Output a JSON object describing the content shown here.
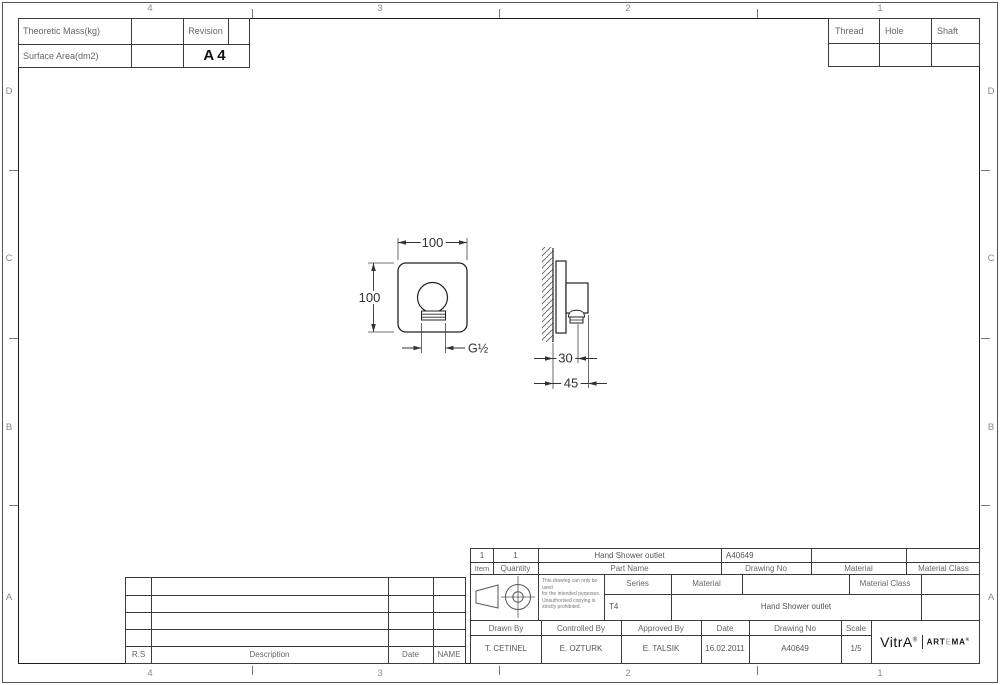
{
  "sheet": {
    "paper_size": "A4",
    "bg_color": "#ffffff",
    "line_color": "#3a3a3a",
    "frame_color": "#1a1a1a"
  },
  "zones": {
    "row_letters": [
      "D",
      "C",
      "B",
      "A"
    ],
    "col_numbers": [
      "4",
      "3",
      "2",
      "1"
    ]
  },
  "top_left_table": {
    "theoretic_mass_label": "Theoretic Mass(kg)",
    "theoretic_mass_value": "",
    "revision_label": "Revision",
    "revision_value": "",
    "surface_area_label": "Surface Area(dm2)",
    "surface_area_value": "",
    "paper_size": "A4"
  },
  "top_right_table": {
    "thread_label": "Thread",
    "hole_label": "Hole",
    "shaft_label": "Shaft",
    "thread_value": "",
    "hole_value": "",
    "shaft_value": ""
  },
  "views": {
    "front": {
      "width_dim": "100",
      "height_dim": "100",
      "thread_dim": "G½"
    },
    "side": {
      "depth_dim": "30",
      "total_depth_dim": "45"
    }
  },
  "revision_table": {
    "rs_label": "R.S",
    "description_label": "Description",
    "date_label": "Date",
    "name_label": "NAME"
  },
  "title_block": {
    "item_label": "Item",
    "item_value": "1",
    "quantity_label": "Quantity",
    "quantity_value": "1",
    "part_name_label": "Part Name",
    "part_name_value": "Hand Shower outlet",
    "drawing_no_label": "Drawing No",
    "drawing_no_value": "A40649",
    "material_label": "Material",
    "material_value": "",
    "material_class_label": "Material Class",
    "material_class_value": "",
    "disclaimer_line1": "This drawing can only be used",
    "disclaimer_line2": "for the intended purposes.",
    "disclaimer_line3": "Unauthorised copying is",
    "disclaimer_line4": "strictly prohibited.",
    "series_label": "Series",
    "series_value": "T4",
    "product_name": "Hand Shower outlet",
    "drawn_by_label": "Drawn By",
    "drawn_by_value": "T. CETINEL",
    "controlled_by_label": "Controlled By",
    "controlled_by_value": "E. OZTURK",
    "approved_by_label": "Approved By",
    "approved_by_value": "E. TALSIK",
    "date_label": "Date",
    "date_value": "16.02.2011",
    "scale_label": "Scale",
    "scale_value": "1/5",
    "logo_vitra": "VitrA",
    "logo_reg": "®",
    "logo_artema_a": "ART",
    "logo_artema_e": "E",
    "logo_artema_ma": "MA"
  }
}
